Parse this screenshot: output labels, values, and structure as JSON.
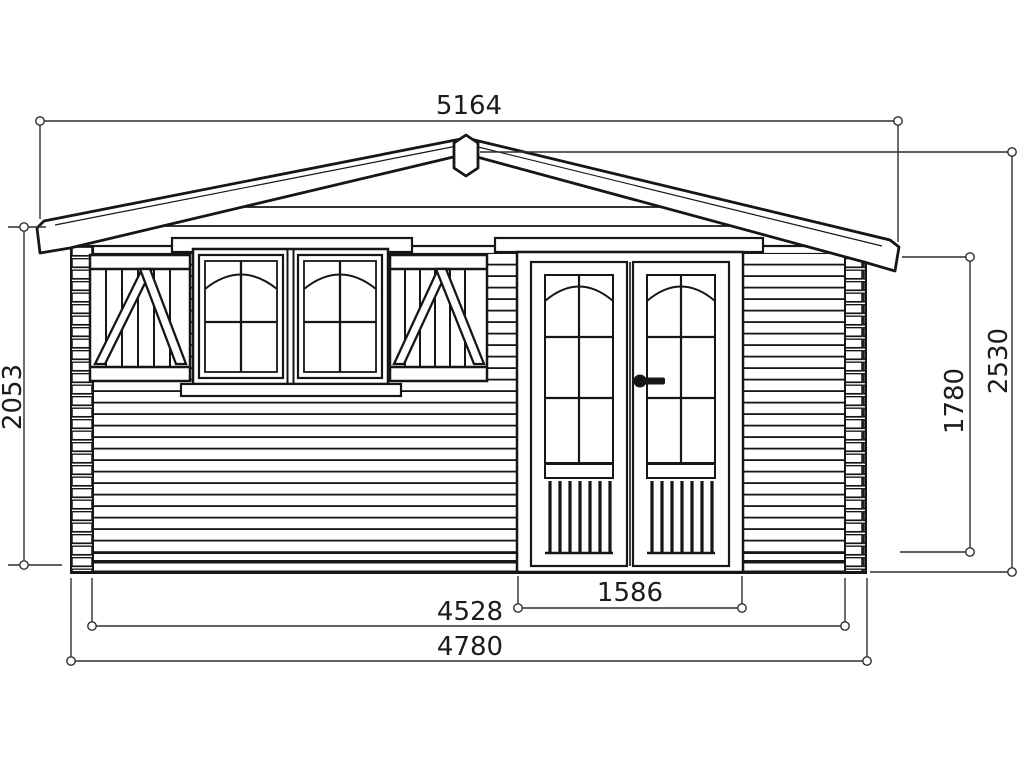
{
  "drawing": {
    "type": "technical front elevation",
    "subject": "log cabin garden shed with shuttered window and double glazed doors",
    "units_shown": false,
    "dims": {
      "roof_width": "5164",
      "left_wall_height": "2053",
      "ridge_height": "2530",
      "eave_underside_height": "1780",
      "door_width": "1586",
      "wall_inner_width": "4528",
      "wall_overall_width": "4780"
    },
    "colors": {
      "background": "#ffffff",
      "line": "#161616",
      "dimension_line": "#2f2f2f"
    }
  }
}
